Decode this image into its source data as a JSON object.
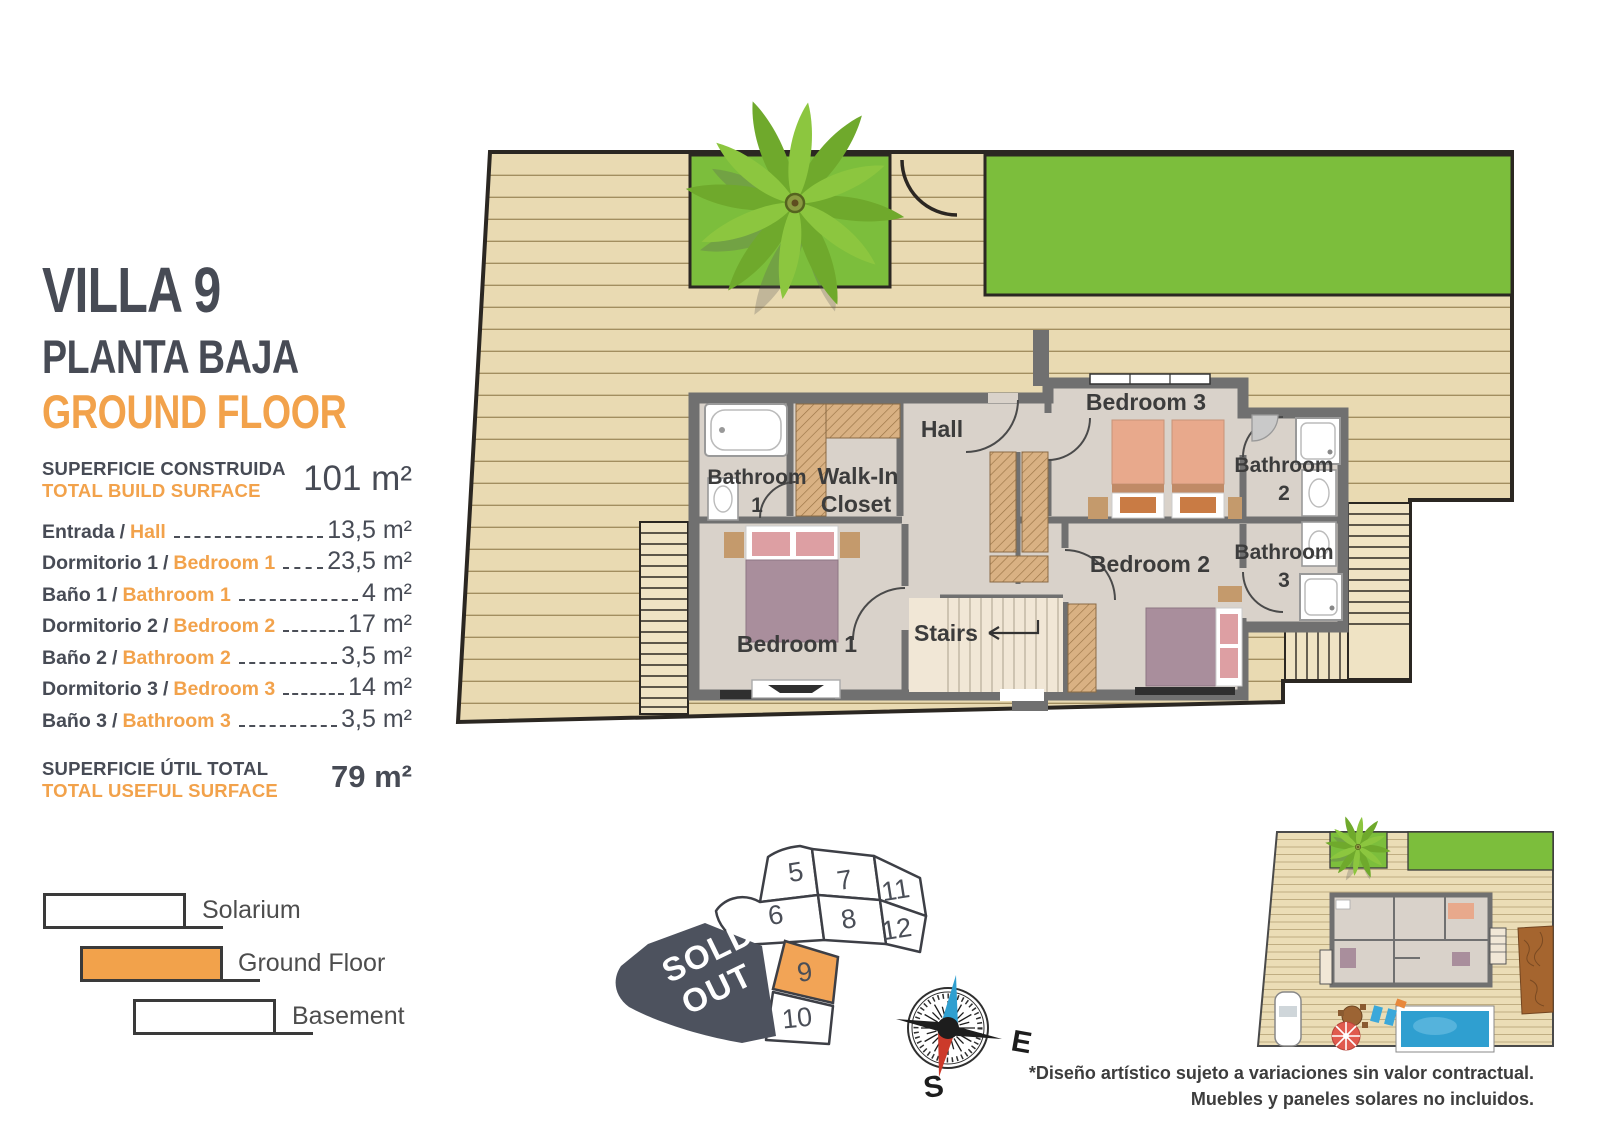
{
  "header": {
    "villa": "VILLA 9",
    "floor_es": "PLANTA BAJA",
    "floor_en": "GROUND FLOOR"
  },
  "build_surface": {
    "label_es": "SUPERFICIE CONSTRUIDA",
    "label_en": "TOTAL BUILD SURFACE",
    "value": "101 m²"
  },
  "separator": "/",
  "rooms_table": [
    {
      "es": "Entrada",
      "en": "Hall",
      "value": "13,5 m²"
    },
    {
      "es": "Dormitorio 1",
      "en": "Bedroom 1",
      "value": "23,5 m²"
    },
    {
      "es": "Baño 1",
      "en": "Bathroom 1",
      "value": "4 m²"
    },
    {
      "es": "Dormitorio 2",
      "en": "Bedroom 2",
      "value": "17 m²"
    },
    {
      "es": "Baño 2",
      "en": "Bathroom 2",
      "value": "3,5 m²"
    },
    {
      "es": "Dormitorio 3",
      "en": "Bedroom 3",
      "value": "14 m²"
    },
    {
      "es": "Baño 3",
      "en": "Bathroom 3",
      "value": "3,5 m²"
    }
  ],
  "useful_surface": {
    "label_es": "SUPERFICIE ÚTIL TOTAL",
    "label_en": "TOTAL USEFUL SURFACE",
    "value": "79 m²"
  },
  "legend": {
    "items": [
      {
        "label": "Solarium",
        "highlighted": false
      },
      {
        "label": "Ground Floor",
        "highlighted": true
      },
      {
        "label": "Basement",
        "highlighted": false
      }
    ]
  },
  "floor_plan": {
    "rooms": [
      {
        "id": "hall",
        "lines": [
          "Hall"
        ]
      },
      {
        "id": "walk-in-closet",
        "lines": [
          "Walk-In",
          "Closet"
        ]
      },
      {
        "id": "bathroom-1",
        "lines": [
          "Bathroom",
          "1"
        ]
      },
      {
        "id": "bedroom-3",
        "lines": [
          "Bedroom 3"
        ]
      },
      {
        "id": "bathroom-2",
        "lines": [
          "Bathroom",
          "2"
        ]
      },
      {
        "id": "bedroom-2",
        "lines": [
          "Bedroom 2"
        ]
      },
      {
        "id": "bathroom-3",
        "lines": [
          "Bathroom",
          "3"
        ]
      },
      {
        "id": "bedroom-1",
        "lines": [
          "Bedroom 1"
        ]
      },
      {
        "id": "stairs",
        "lines": [
          "Stairs"
        ]
      }
    ]
  },
  "plot_map": {
    "plots": [
      "5",
      "7",
      "11",
      "6",
      "8",
      "12",
      "9",
      "10"
    ],
    "highlighted_plot": "9",
    "sold_out_lines": [
      "SOLD",
      "OUT"
    ]
  },
  "compass": {
    "east": "E",
    "south": "S"
  },
  "disclaimer": {
    "line1": "*Diseño artístico sujeto a variaciones sin valor contractual.",
    "line2": "Muebles y paneles solares no incluidos."
  },
  "colors": {
    "accent_orange": "#F2A24B",
    "dark_slate": "#474B55",
    "wall_gray": "#707070",
    "deck_tan": "#E9DAB2",
    "lawn_green": "#7CBE3C",
    "floor_gray": "#D9D2CA",
    "sold_out_dark": "#4D525E",
    "pool_blue": "#2F9FD0",
    "compass_north_blue": "#2F9FD0",
    "compass_south_red": "#CC3A2B"
  }
}
